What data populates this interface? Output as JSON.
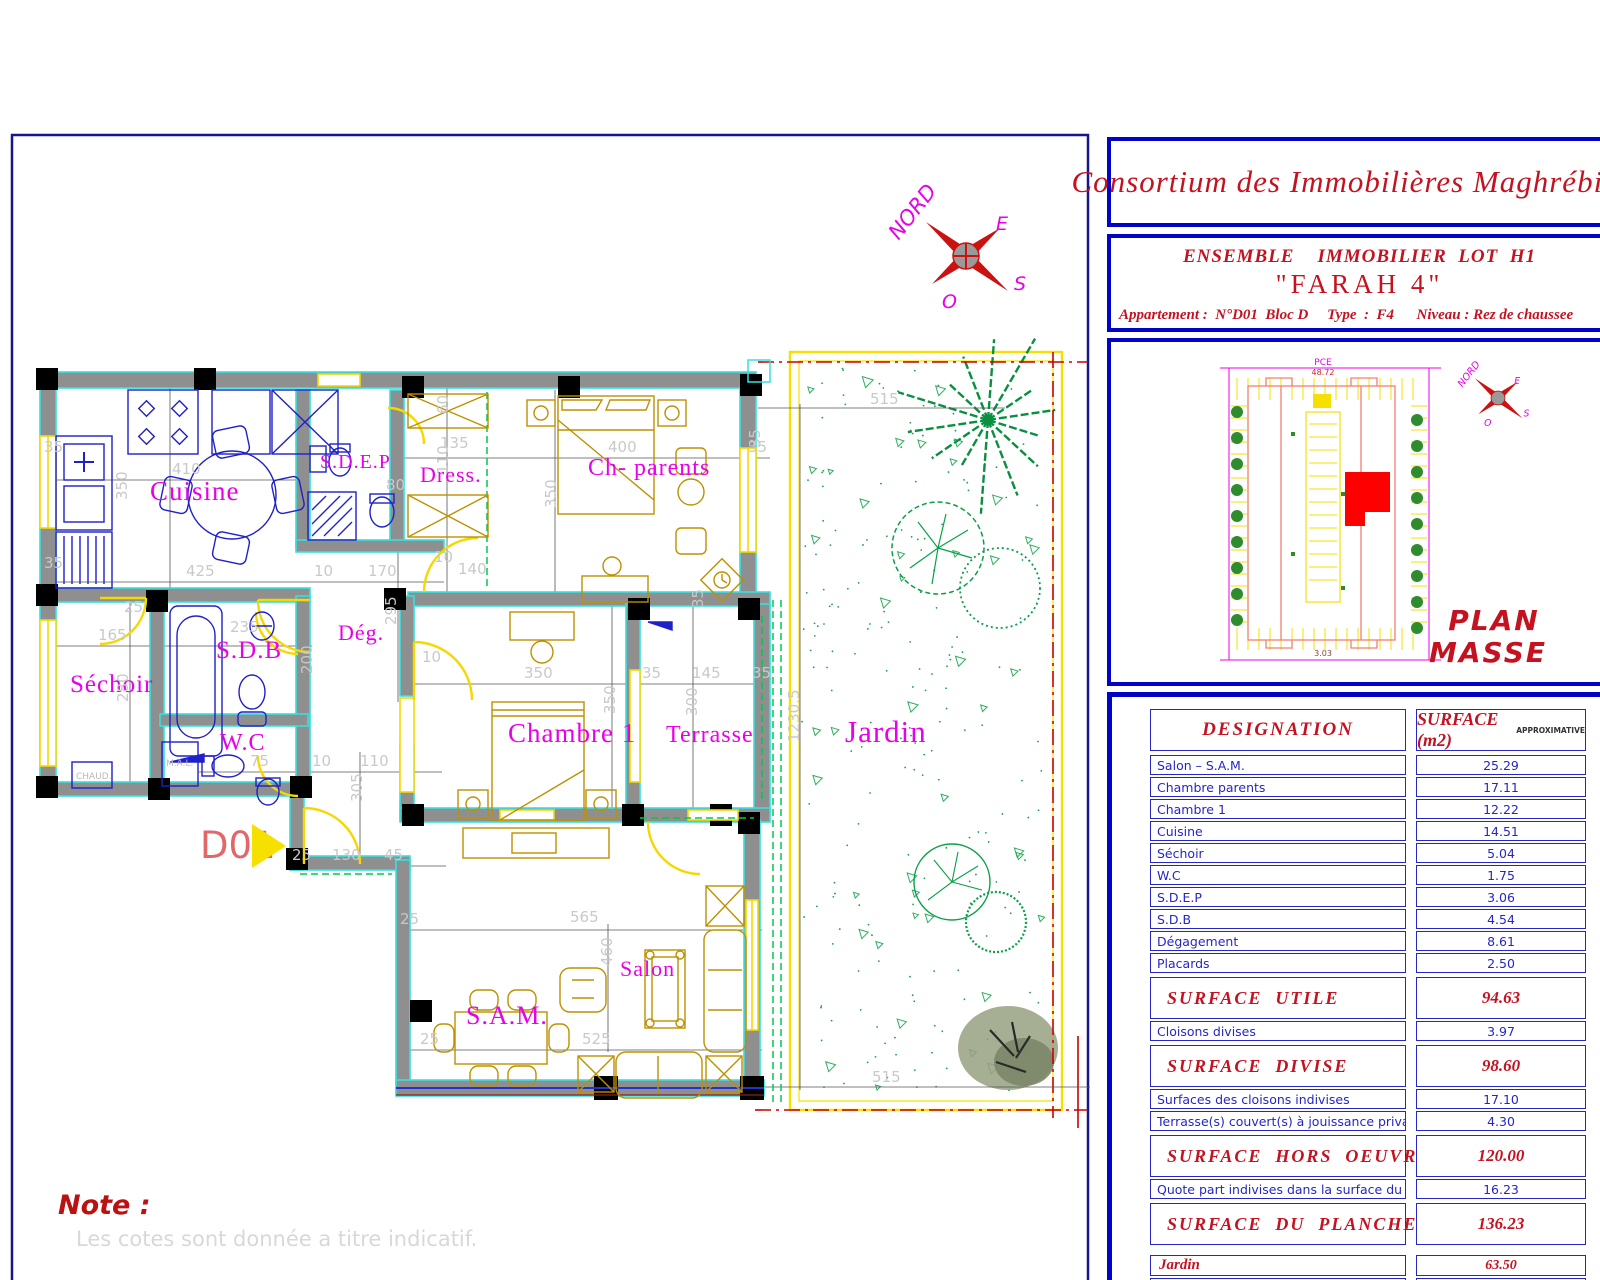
{
  "title_block": {
    "company": "Consortium des Immobilières Maghrébines",
    "project_line1": "ENSEMBLE    IMMOBILIER  LOT  H1",
    "project_name": "\"FARAH 4\"",
    "apartment_line": "Appartement :  N°D01  Bloc D     Type  :  F4      Niveau : Rez de chaussee"
  },
  "plan_masse": {
    "label_line1": "PLAN",
    "label_line2": "MASSE",
    "street_label": "PCE",
    "street_value": "48.72",
    "bottom_value": "3.03"
  },
  "compass": {
    "north": "NORD",
    "east": "E",
    "west": "O",
    "south": "S"
  },
  "note": {
    "title": "Note :",
    "text": "Les  cotes  sont  donnée  a  titre  indicatif."
  },
  "floor_plan": {
    "entrance_label": "D01",
    "fixture_labels": {
      "washing_machine": "M.A.L.",
      "boiler": "CHAUD."
    },
    "rooms": [
      {
        "t": "Cuisine",
        "x": 150,
        "y": 500,
        "s": 27
      },
      {
        "t": "S.D.E.P",
        "x": 320,
        "y": 468,
        "s": 20
      },
      {
        "t": "Dress.",
        "x": 420,
        "y": 482,
        "s": 22
      },
      {
        "t": "Ch- parents",
        "x": 588,
        "y": 475,
        "s": 24
      },
      {
        "t": "Séchoir",
        "x": 70,
        "y": 692,
        "s": 25
      },
      {
        "t": "S.D.B",
        "x": 216,
        "y": 658,
        "s": 25
      },
      {
        "t": "W.C",
        "x": 220,
        "y": 750,
        "s": 24
      },
      {
        "t": "Dég.",
        "x": 338,
        "y": 640,
        "s": 22
      },
      {
        "t": "Chambre 1",
        "x": 508,
        "y": 742,
        "s": 27
      },
      {
        "t": "Terrasse",
        "x": 666,
        "y": 742,
        "s": 24
      },
      {
        "t": "Salon",
        "x": 620,
        "y": 976,
        "s": 22
      },
      {
        "t": "S.A.M.",
        "x": 466,
        "y": 1024,
        "s": 26
      },
      {
        "t": "Jardin",
        "x": 845,
        "y": 742,
        "s": 31
      }
    ],
    "dimensions": [
      {
        "t": "410",
        "x": 172,
        "y": 474
      },
      {
        "t": "350",
        "x": 127,
        "y": 500,
        "r": -90
      },
      {
        "t": "35",
        "x": 44,
        "y": 452
      },
      {
        "t": "35",
        "x": 44,
        "y": 568
      },
      {
        "t": "425",
        "x": 186,
        "y": 576
      },
      {
        "t": "10",
        "x": 314,
        "y": 576
      },
      {
        "t": "170",
        "x": 368,
        "y": 576
      },
      {
        "t": "80",
        "x": 386,
        "y": 490
      },
      {
        "t": "135",
        "x": 440,
        "y": 448
      },
      {
        "t": "110",
        "x": 448,
        "y": 474,
        "r": -90
      },
      {
        "t": "60",
        "x": 448,
        "y": 414,
        "r": -90
      },
      {
        "t": "400",
        "x": 608,
        "y": 452
      },
      {
        "t": "35",
        "x": 748,
        "y": 452
      },
      {
        "t": "350",
        "x": 556,
        "y": 508,
        "r": -90
      },
      {
        "t": "140",
        "x": 458,
        "y": 574
      },
      {
        "t": "10",
        "x": 434,
        "y": 562
      },
      {
        "t": "165",
        "x": 98,
        "y": 640
      },
      {
        "t": "25",
        "x": 124,
        "y": 612
      },
      {
        "t": "280",
        "x": 128,
        "y": 702,
        "r": -90
      },
      {
        "t": "235",
        "x": 230,
        "y": 632
      },
      {
        "t": "200",
        "x": 312,
        "y": 674,
        "r": -90
      },
      {
        "t": "295",
        "x": 396,
        "y": 625,
        "r": -90
      },
      {
        "t": "75",
        "x": 250,
        "y": 766
      },
      {
        "t": "10",
        "x": 312,
        "y": 766
      },
      {
        "t": "110",
        "x": 360,
        "y": 766
      },
      {
        "t": "25",
        "x": 292,
        "y": 860
      },
      {
        "t": "130",
        "x": 332,
        "y": 860
      },
      {
        "t": "45",
        "x": 384,
        "y": 860
      },
      {
        "t": "305",
        "x": 362,
        "y": 802,
        "r": -90
      },
      {
        "t": "350",
        "x": 524,
        "y": 678
      },
      {
        "t": "350",
        "x": 615,
        "y": 714,
        "r": -90
      },
      {
        "t": "10",
        "x": 422,
        "y": 662
      },
      {
        "t": "35",
        "x": 642,
        "y": 678
      },
      {
        "t": "145",
        "x": 692,
        "y": 678
      },
      {
        "t": "35",
        "x": 752,
        "y": 678
      },
      {
        "t": "300",
        "x": 697,
        "y": 716,
        "r": -90
      },
      {
        "t": "35",
        "x": 703,
        "y": 608,
        "r": -90
      },
      {
        "t": "35",
        "x": 760,
        "y": 448,
        "r": -90
      },
      {
        "t": "25",
        "x": 400,
        "y": 924
      },
      {
        "t": "565",
        "x": 570,
        "y": 922
      },
      {
        "t": "25",
        "x": 420,
        "y": 1044
      },
      {
        "t": "525",
        "x": 582,
        "y": 1044
      },
      {
        "t": "460",
        "x": 612,
        "y": 966,
        "r": -90
      },
      {
        "t": "515",
        "x": 870,
        "y": 404
      },
      {
        "t": "515",
        "x": 872,
        "y": 1082
      },
      {
        "t": "1230.5",
        "x": 799,
        "y": 742,
        "r": -90
      }
    ]
  },
  "surface_table": {
    "headers": {
      "designation": "DESIGNATION",
      "surface": "SURFACE  (m2)",
      "surface_suffix": "APPROXIMATIVE"
    },
    "rows": [
      {
        "label": "Salon – S.A.M.",
        "value": "25.29",
        "type": "normal"
      },
      {
        "label": "Chambre parents",
        "value": "17.11",
        "type": "normal"
      },
      {
        "label": "Chambre 1",
        "value": "12.22",
        "type": "normal"
      },
      {
        "label": "Cuisine",
        "value": "14.51",
        "type": "normal"
      },
      {
        "label": "Séchoir",
        "value": "5.04",
        "type": "normal"
      },
      {
        "label": "W.C",
        "value": "1.75",
        "type": "normal"
      },
      {
        "label": "S.D.E.P",
        "value": "3.06",
        "type": "normal"
      },
      {
        "label": "S.D.B",
        "value": "4.54",
        "type": "normal"
      },
      {
        "label": "Dégagement",
        "value": "8.61",
        "type": "normal"
      },
      {
        "label": "Placards",
        "value": "2.50",
        "type": "normal"
      },
      {
        "label": "SURFACE  UTILE",
        "value": "94.63",
        "type": "section"
      },
      {
        "label": "Cloisons divises",
        "value": "3.97",
        "type": "normal"
      },
      {
        "label": "SURFACE  DIVISE",
        "value": "98.60",
        "type": "section"
      },
      {
        "label": "Surfaces des cloisons indivises",
        "value": "17.10",
        "type": "normal"
      },
      {
        "label": "Terrasse(s) couvert(s) à jouissance privative",
        "value": "4.30",
        "type": "normal"
      },
      {
        "label": "SURFACE  HORS  OEUVRE",
        "value": "120.00",
        "type": "section"
      },
      {
        "label": "Quote part indivises dans la surface du plancher",
        "value": "16.23",
        "type": "normal"
      },
      {
        "label": "SURFACE  DU  PLANCHER",
        "value": "136.23",
        "type": "section"
      },
      {
        "label": "Jardin",
        "value": "63.50",
        "type": "annex",
        "gap": true
      },
      {
        "label": "Numéro de la place de parking",
        "value": "--",
        "type": "annex"
      }
    ]
  },
  "colors": {
    "frame_blue": "#16168c",
    "panel_blue": "#0004c8",
    "title_red": "#c41220",
    "table_blue": "#2526c4",
    "room_magenta": "#e800e8",
    "wall_gray": "#8f8f8f",
    "wall_edge_cyan": "#35e0e0",
    "opening_yellow": "#f5d800",
    "garden_green": "#0aa048",
    "highlight_red": "#ff0000"
  }
}
